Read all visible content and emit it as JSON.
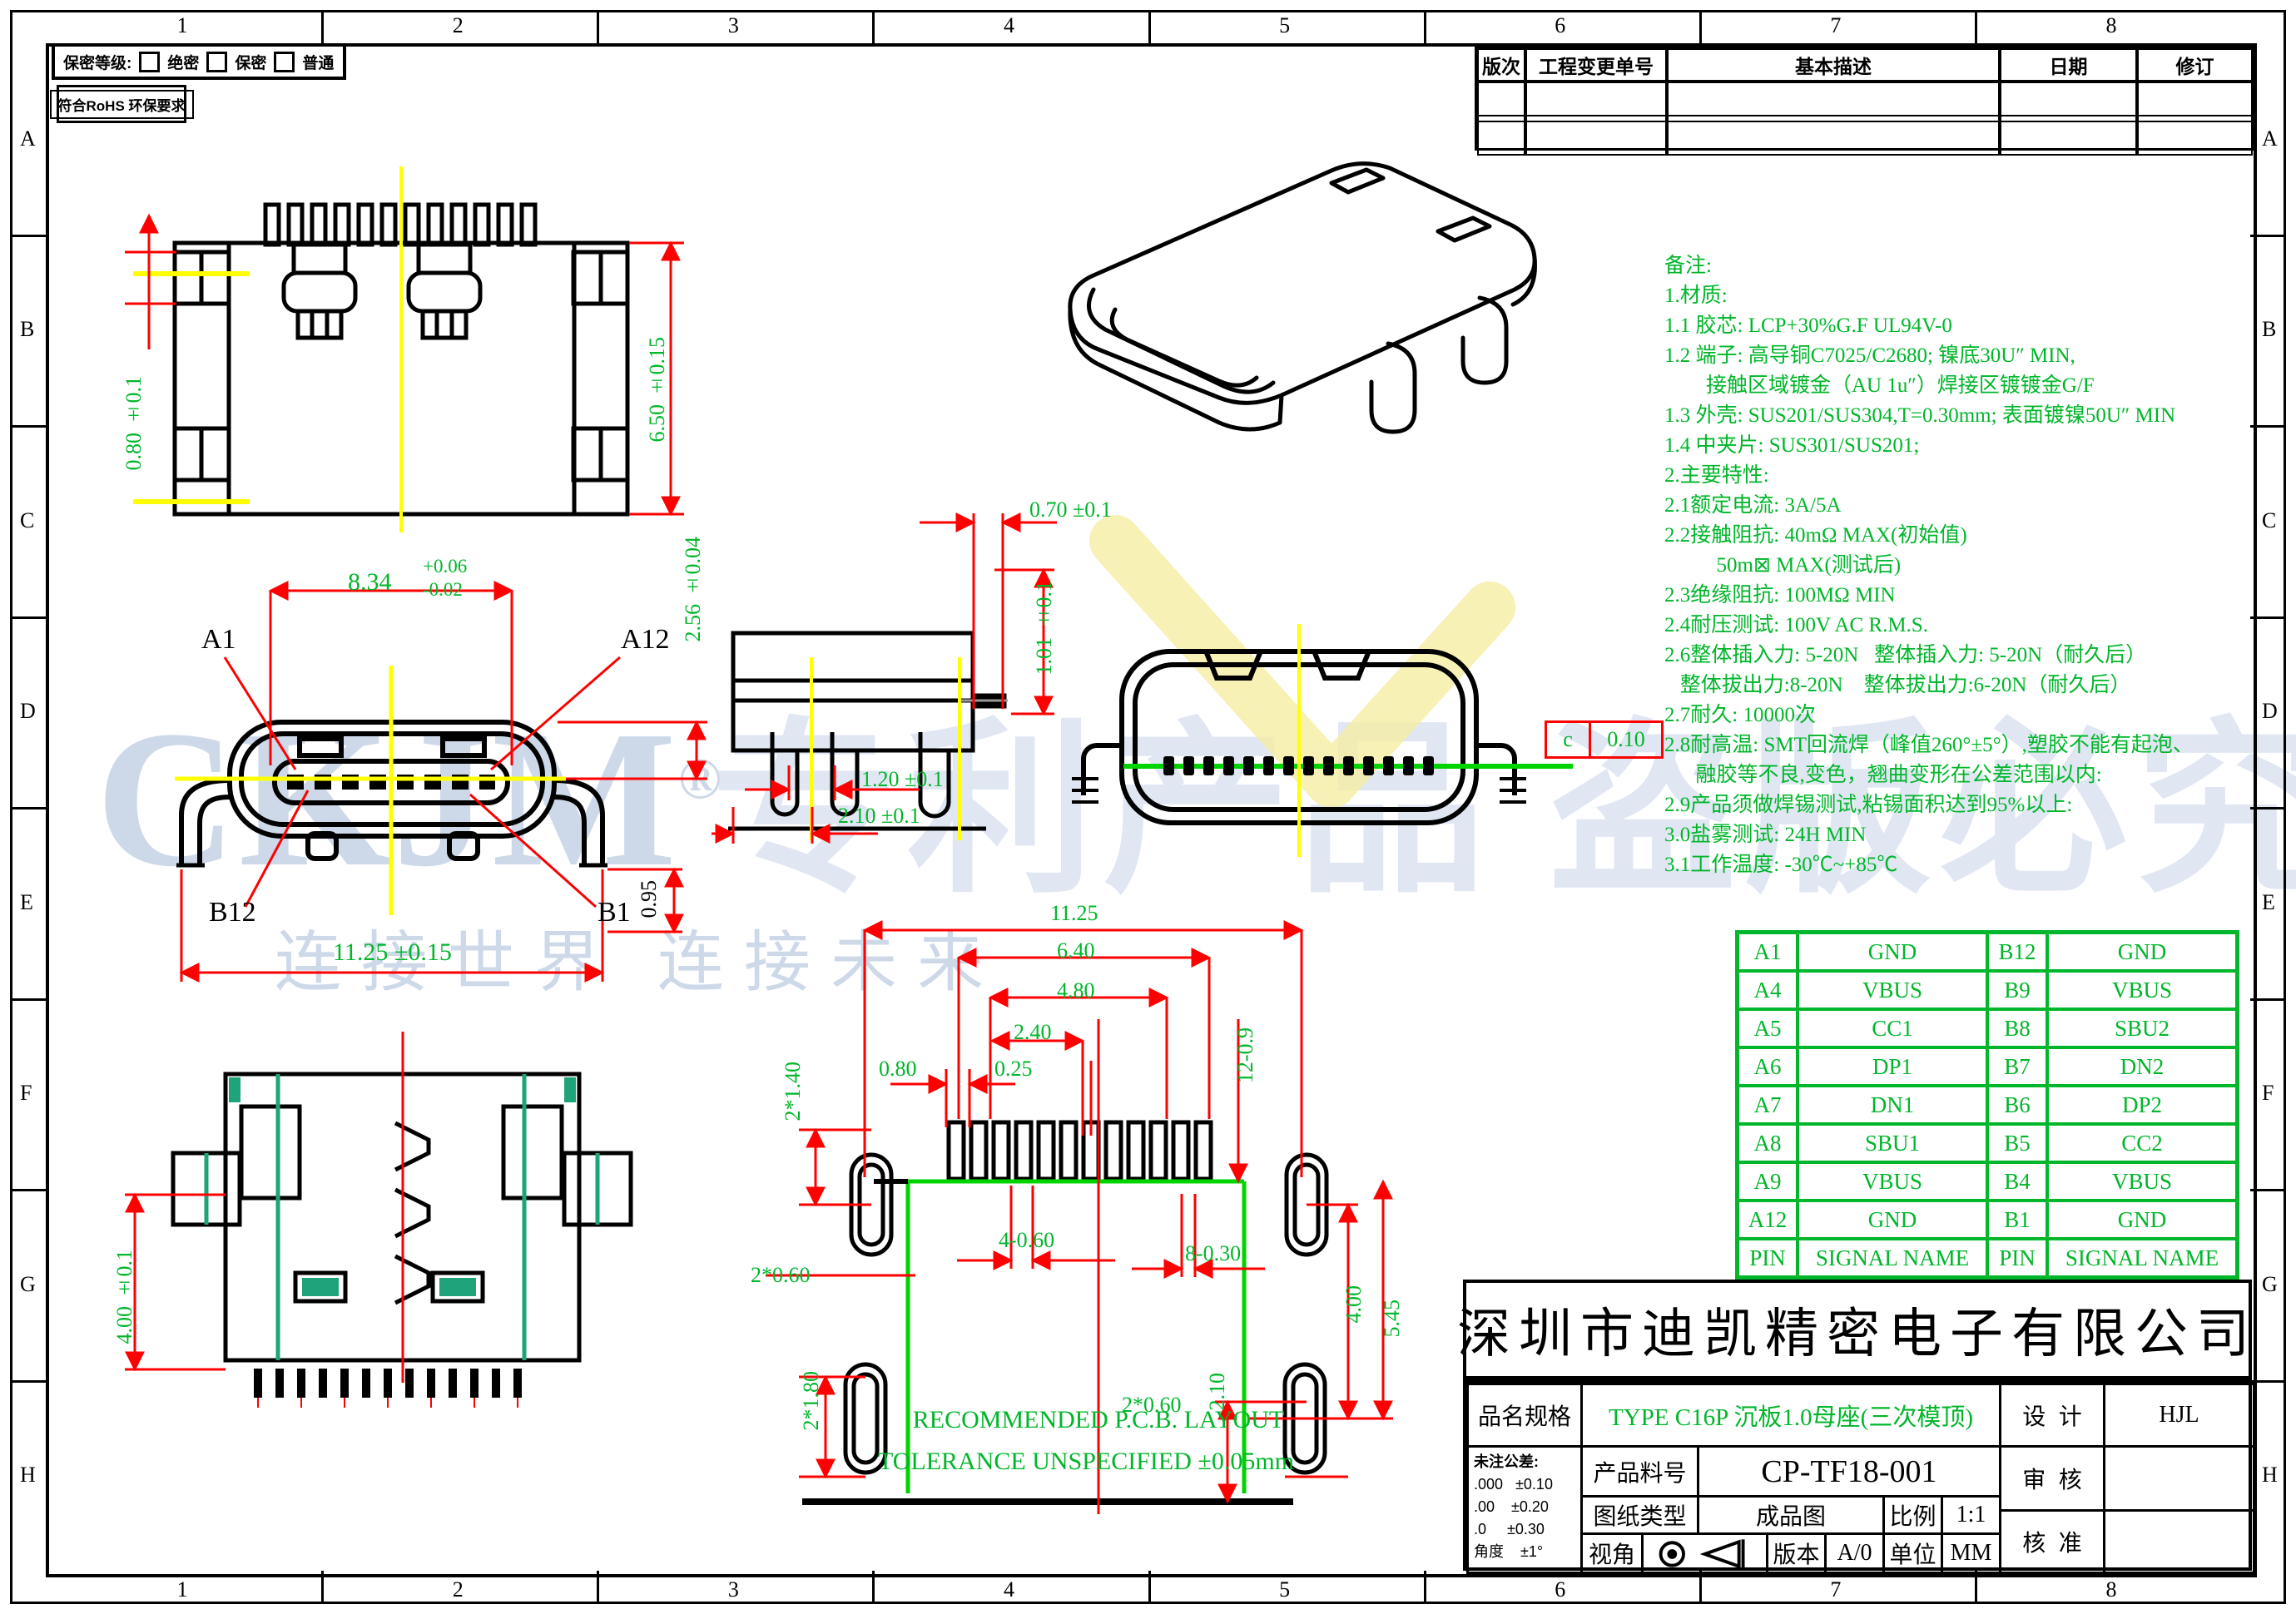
{
  "border": {
    "cols": [
      "1",
      "2",
      "3",
      "4",
      "5",
      "6",
      "7",
      "8"
    ],
    "rows": [
      "A",
      "B",
      "C",
      "D",
      "E",
      "F",
      "G",
      "H"
    ]
  },
  "security": {
    "label": "保密等级:",
    "options": [
      "绝密",
      "保密",
      "普通"
    ],
    "rohs": "符合RoHS 环保要求"
  },
  "revision": {
    "headers": [
      "版次",
      "工程变更单号",
      "基本描述",
      "日期",
      "修订"
    ]
  },
  "notes": {
    "lines": [
      "备注:",
      "1.材质:",
      "1.1 胶芯: LCP+30%G.F UL94V-0",
      "1.2 端子: 高导铜C7025/C2680; 镍底30U″ MIN,",
      "        接触区域镀金（AU 1u″）焊接区镀镀金G/F",
      "1.3 外壳: SUS201/SUS304,T=0.30mm; 表面镀镍50U″ MIN",
      "1.4 中夹片: SUS301/SUS201;",
      "2.主要特性:",
      "2.1额定电流: 3A/5A",
      "2.2接触阻抗: 40mΩ MAX(初始值)",
      "          50m⊠ MAX(测试后)",
      "2.3绝缘阻抗: 100MΩ MIN",
      "2.4耐压测试: 100V AC R.M.S.",
      "2.6整体插入力: 5-20N   整体插入力: 5-20N（耐久后）",
      "   整体拔出力:8-20N    整体拔出力:6-20N（耐久后）",
      "2.7耐久: 10000次",
      "2.8耐高温: SMT回流焊（峰值260°±5°）,塑胶不能有起泡、",
      "      融胶等不良,变色，翘曲变形在公差范围以内:",
      "2.9产品须做焊锡测试,粘锡面积达到95%以上:",
      "3.0盐雾测试: 24H MIN",
      "3.1工作温度: -30℃~+85℃"
    ]
  },
  "pin_table": {
    "rows": [
      [
        "A1",
        "GND",
        "B12",
        "GND"
      ],
      [
        "A4",
        "VBUS",
        "B9",
        "VBUS"
      ],
      [
        "A5",
        "CC1",
        "B8",
        "SBU2"
      ],
      [
        "A6",
        "DP1",
        "B7",
        "DN2"
      ],
      [
        "A7",
        "DN1",
        "B6",
        "DP2"
      ],
      [
        "A8",
        "SBU1",
        "B5",
        "CC2"
      ],
      [
        "A9",
        "VBUS",
        "B4",
        "VBUS"
      ],
      [
        "A12",
        "GND",
        "B1",
        "GND"
      ],
      [
        "PIN",
        "SIGNAL NAME",
        "PIN",
        "SIGNAL NAME"
      ]
    ]
  },
  "dims": {
    "v1_h1": "0.80 ±0.1",
    "v1_h2": "6.50 ±0.15",
    "v2_w": "8.34",
    "v2_wu": "+0.06",
    "v2_wd": "-0.02",
    "v2_a1": "A1",
    "v2_a12": "A12",
    "v2_b12": "B12",
    "v2_b1": "B1",
    "v2_total": "11.25 ±0.15",
    "v2_leg": "0.95",
    "v2_h": "2.56 ±0.04",
    "v3_d1": "0.70 ±0.1",
    "v3_d2": "1.01 ±0.1",
    "v3_d3": "1.20 ±0.1",
    "v3_d4": "2.10 ±0.1",
    "v4_datum": "c",
    "v4_val": "0.10",
    "v5_d": "4.00 ±0.1",
    "p1": "11.25",
    "p2": "6.40",
    "p3": "4.80",
    "p4": "2.40",
    "p5": "0.25",
    "p6": "0.80",
    "p7": "12-0.9",
    "p8": "2*1.40",
    "p9": "2*0.60",
    "p10": "4-0.60",
    "p11": "8-0.30",
    "p12": "4.00",
    "p13": "5.45",
    "p14": "2*1.80",
    "p15": "2.10",
    "p16": "2*0.60"
  },
  "captions": {
    "line1": "RECOMMENDED  P.C.B. LAYOUT",
    "line2": "TOLERANCE UNSPECIFIED  ±0.05mm"
  },
  "title_block": {
    "company": "深圳市迪凯精密电子有限公司",
    "name_label": "品名规格",
    "name_value": "TYPE C16P 沉板1.0母座(三次模顶)",
    "design_label": "设  计",
    "design_value": "HJL",
    "check_label": "审  核",
    "check_value": "",
    "approve_label": "核  准",
    "approve_value": "",
    "pn_label": "产品料号",
    "pn_value": "CP-TF18-001",
    "type_label": "图纸类型",
    "type_value": "成品图",
    "scale_label": "比例",
    "scale_value": "1:1",
    "view_label": "视角",
    "version_label": "版本",
    "version_value": "A/0",
    "unit_label": "单位",
    "unit_value": "MM",
    "tol_header": "未注公差:",
    "tol_lines": [
      ".000   ±0.10",
      ".00    ±0.20",
      ".0     ±0.30",
      "角度    ±1°"
    ]
  },
  "watermark": {
    "brand": "CKJM",
    "reg": "®",
    "slogan": "连接世界  连接未来",
    "big": "专利产品 盗版必究"
  },
  "colors": {
    "dim_green": "#00b62a",
    "pcb_green": "#00d400",
    "line_red": "#ff0000",
    "teal": "#1fa37a",
    "centerline_yellow": "#ffff00",
    "watermark_blue": "#cdd9e9"
  }
}
